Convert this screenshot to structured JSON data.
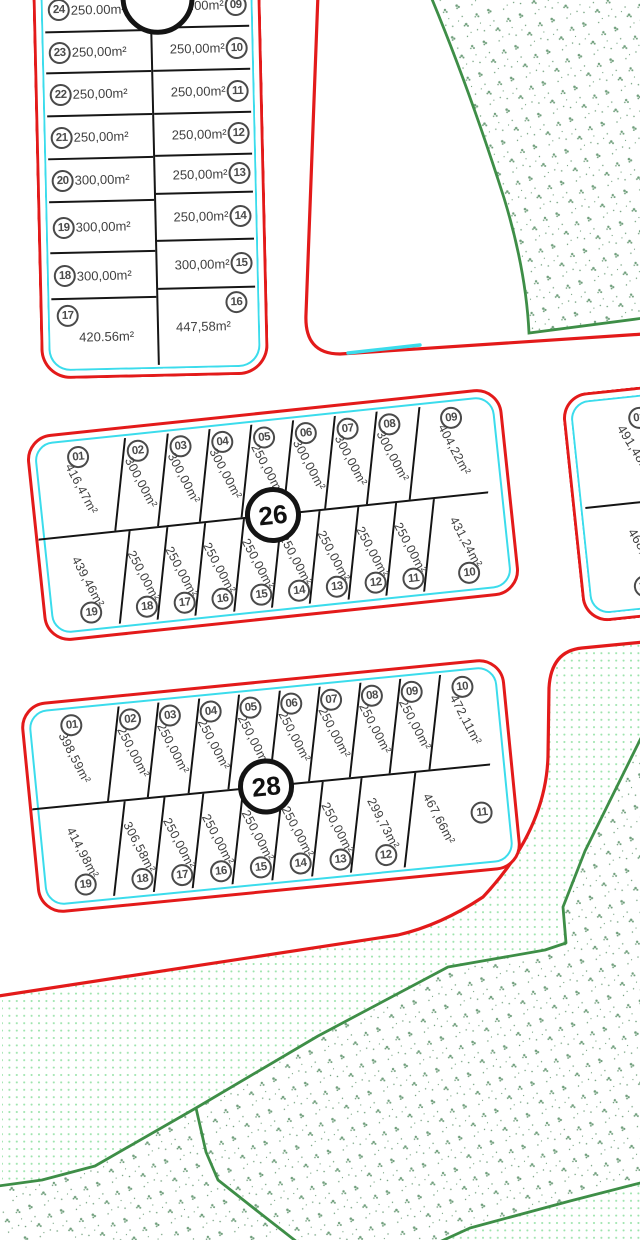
{
  "title": "Cadastral parcel plan",
  "colors": {
    "road_red": "#e31a1a",
    "curb_cyan": "#3bdcec",
    "parcel_line": "#161616",
    "circle_gray": "#4a4a4a",
    "veg_boundary_green": "#3e8e47",
    "veg_speckle": "#6f9e7b",
    "veg_dots": "#9be3ab"
  },
  "blocks": {
    "top": {
      "number": "",
      "left_plots": [
        {
          "n": "24",
          "area": "250.00m²"
        },
        {
          "n": "23",
          "area": "250,00m²"
        },
        {
          "n": "22",
          "area": "250,00m²"
        },
        {
          "n": "21",
          "area": "250,00m²"
        },
        {
          "n": "20",
          "area": "300,00m²"
        },
        {
          "n": "19",
          "area": "300,00m²"
        },
        {
          "n": "18",
          "area": "300,00m²"
        },
        {
          "n": "17",
          "area": "420.56m²"
        }
      ],
      "right_plots": [
        {
          "n": "09",
          "area": "250.00m²"
        },
        {
          "n": "10",
          "area": "250,00m²"
        },
        {
          "n": "11",
          "area": "250,00m²"
        },
        {
          "n": "12",
          "area": "250,00m²"
        },
        {
          "n": "13",
          "area": "250,00m²"
        },
        {
          "n": "14",
          "area": "250,00m²"
        },
        {
          "n": "15",
          "area": "300,00m²"
        },
        {
          "n": "16",
          "area": "447,58m²"
        }
      ]
    },
    "b26": {
      "number": "26",
      "top_plots": [
        {
          "n": "01",
          "area": "416,47m²"
        },
        {
          "n": "02",
          "area": "300,00m²"
        },
        {
          "n": "03",
          "area": "300,00m²"
        },
        {
          "n": "04",
          "area": "300,00m²"
        },
        {
          "n": "05",
          "area": "250,00m²"
        },
        {
          "n": "06",
          "area": "300,00m²"
        },
        {
          "n": "07",
          "area": "300,00m²"
        },
        {
          "n": "08",
          "area": "300,00m²"
        },
        {
          "n": "09",
          "area": "404,22m²"
        }
      ],
      "bottom_plots": [
        {
          "n": "19",
          "area": "439,46m²"
        },
        {
          "n": "18",
          "area": "250,00m²"
        },
        {
          "n": "17",
          "area": "250,00m²"
        },
        {
          "n": "16",
          "area": "250,00m²"
        },
        {
          "n": "15",
          "area": "250,00m²"
        },
        {
          "n": "14",
          "area": "250,00m²"
        },
        {
          "n": "13",
          "area": "250,00m²"
        },
        {
          "n": "12",
          "area": "250,00m²"
        },
        {
          "n": "11",
          "area": "250,00m²"
        },
        {
          "n": "10",
          "area": "431,24m²"
        }
      ]
    },
    "b28": {
      "number": "28",
      "top_plots": [
        {
          "n": "01",
          "area": "398,59m²"
        },
        {
          "n": "02",
          "area": "250,00m²"
        },
        {
          "n": "03",
          "area": "250,00m²"
        },
        {
          "n": "04",
          "area": "250,00m²"
        },
        {
          "n": "05",
          "area": "250,00m²"
        },
        {
          "n": "06",
          "area": "250,00m²"
        },
        {
          "n": "07",
          "area": "250,00m²"
        },
        {
          "n": "08",
          "area": "250,00m²"
        },
        {
          "n": "09",
          "area": "250,00m²"
        },
        {
          "n": "10",
          "area": "472,11m²"
        }
      ],
      "bottom_plots": [
        {
          "n": "19",
          "area": "414,98m²"
        },
        {
          "n": "18",
          "area": "306,58m²"
        },
        {
          "n": "17",
          "area": "250,00m²"
        },
        {
          "n": "16",
          "area": "250,00m²"
        },
        {
          "n": "15",
          "area": "250,00m²"
        },
        {
          "n": "14",
          "area": "250,00m²"
        },
        {
          "n": "13",
          "area": "250,00m²"
        },
        {
          "n": "12",
          "area": "299,73m²"
        },
        {
          "n": "11",
          "area": "467,66m²"
        }
      ]
    },
    "right": {
      "plots": [
        {
          "n": "01",
          "area": "491,48m²"
        },
        {
          "n": "12",
          "area": "468,58m²"
        }
      ]
    }
  }
}
